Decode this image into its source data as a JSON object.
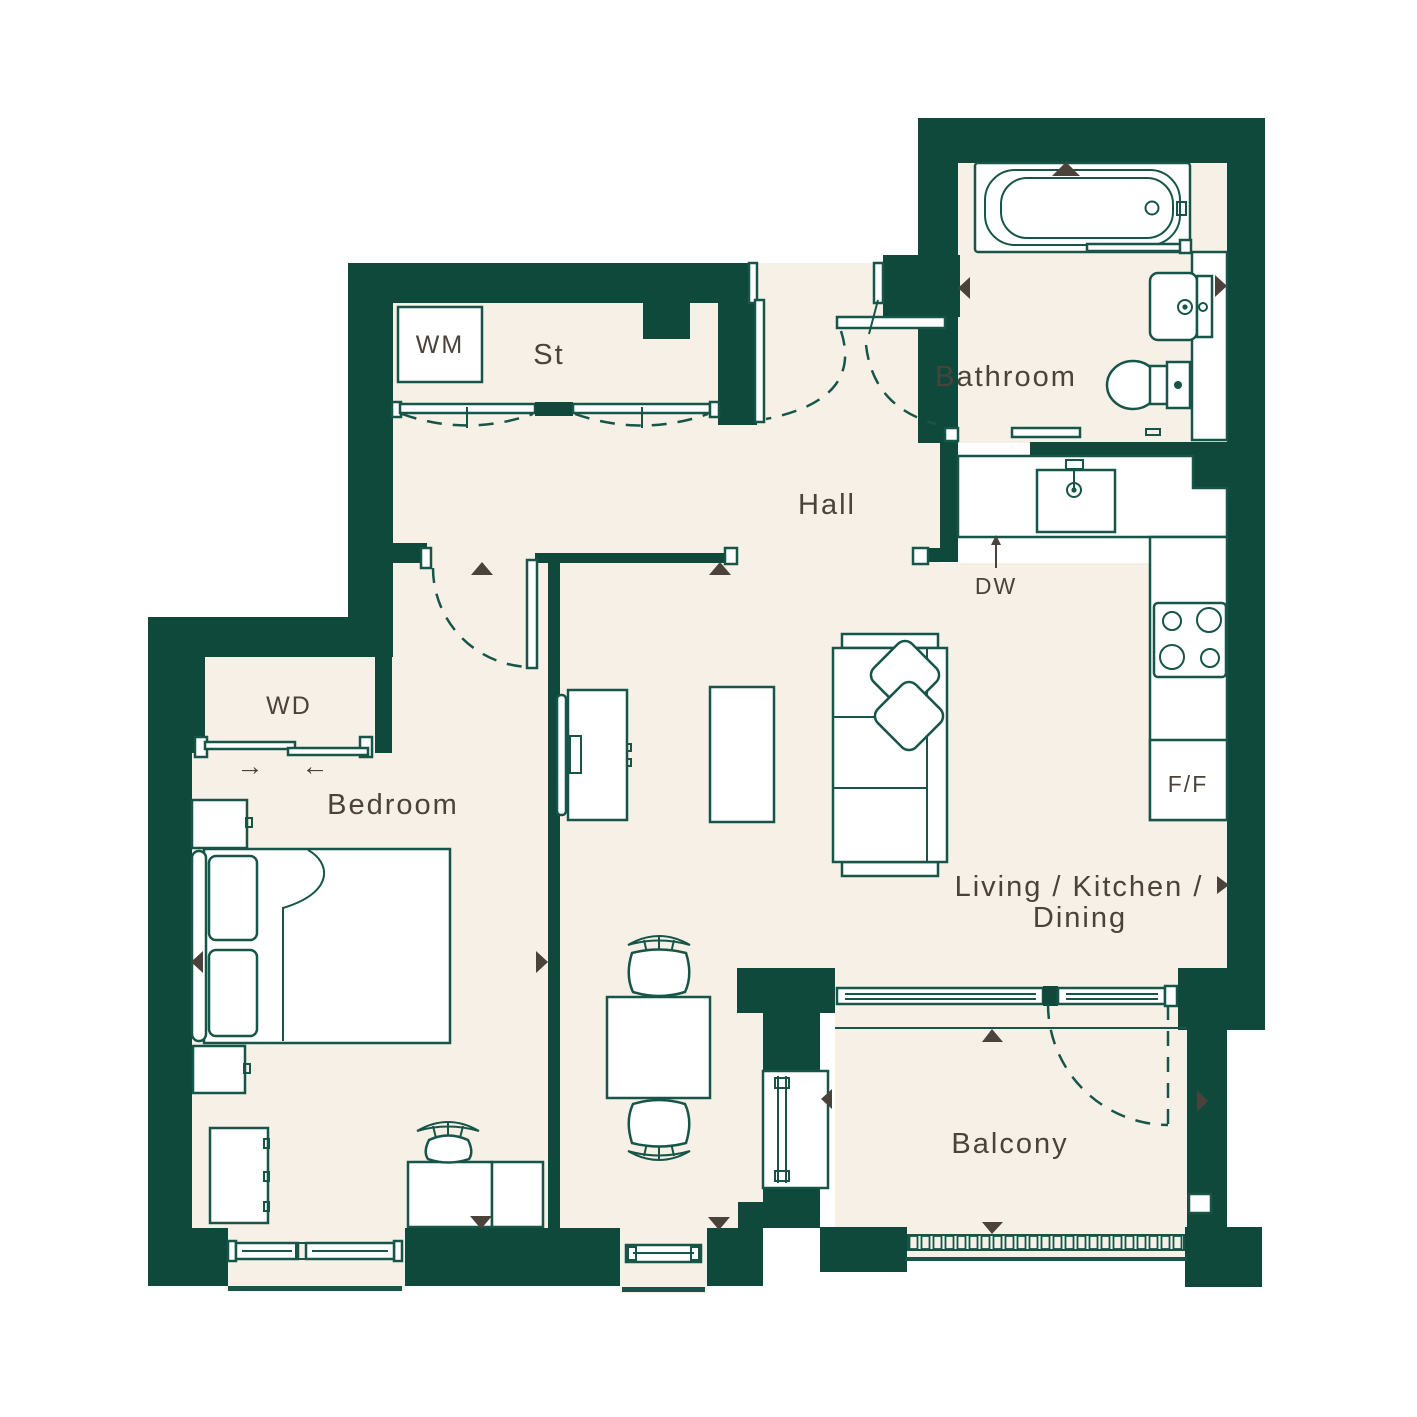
{
  "colors": {
    "wall": "#0e493b",
    "floor": "#f7f0e7",
    "line": "#175548",
    "paper": "#ffffff",
    "marker": "#4b433b",
    "text": "#4b433b"
  },
  "labels": {
    "wm": "WM",
    "st": "St",
    "bathroom": "Bathroom",
    "hall": "Hall",
    "dw": "DW",
    "wd": "WD",
    "bedroom": "Bedroom",
    "living_line1": "Living / Kitchen /",
    "living_line2": "Dining",
    "ff": "F/F",
    "balcony": "Balcony",
    "wd_arrow_right": "→",
    "wd_arrow_left": "←"
  },
  "rooms": [
    {
      "label": "St"
    },
    {
      "label": "Hall"
    },
    {
      "label": "Bathroom"
    },
    {
      "label": "Bedroom"
    },
    {
      "label": "Living / Kitchen / Dining"
    },
    {
      "label": "Balcony"
    }
  ]
}
